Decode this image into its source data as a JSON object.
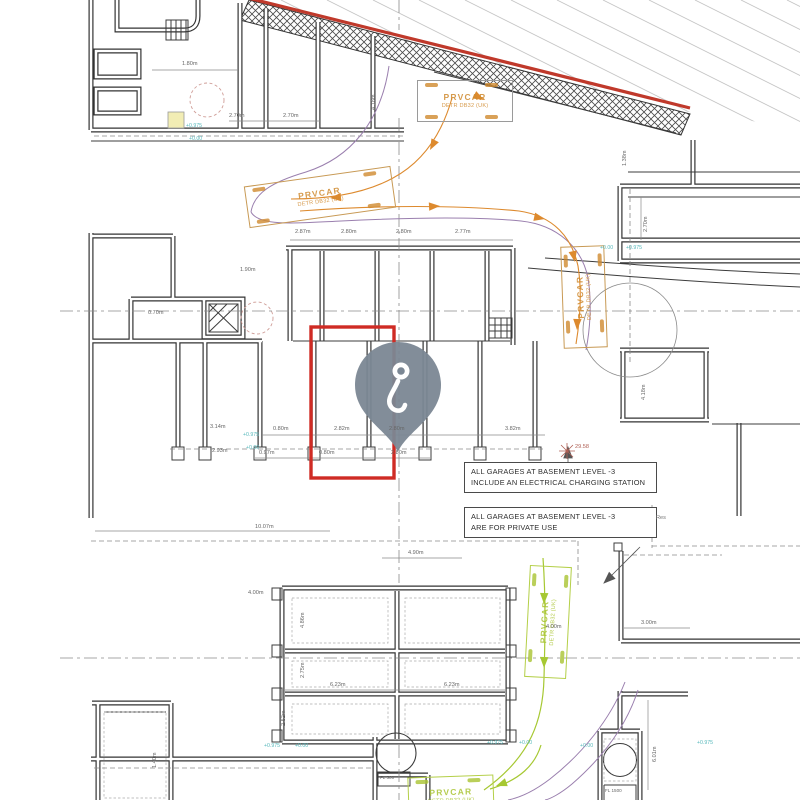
{
  "plan": {
    "notes": [
      {
        "line1": "ALL GARAGES AT BASEMENT LEVEL -3",
        "line2": "INCLUDE AN ELECTRICAL CHARGING STATION"
      },
      {
        "line1": "ALL GARAGES AT BASEMENT LEVEL -3",
        "line2": "ARE FOR PRIVATE USE"
      }
    ],
    "car_stamp": {
      "title": "PRVCAR",
      "subtitle": "DETR DB32 (UK)"
    },
    "levels": {
      "upper": "+0.975",
      "lower": "+0.00"
    },
    "survey_point": "29.58",
    "right_edge_label": "Res",
    "equipment": {
      "small": "FL 500",
      "large": "FL 1500"
    },
    "dims": {
      "t1": "2.70m",
      "t2": "2.70m",
      "t3": "1.80m",
      "t4": "4.18m",
      "m1": "2.87m",
      "m2": "2.80m",
      "m3": "2.80m",
      "m4": "2.77m",
      "m5": "1.90m",
      "m6": "0.70m",
      "b1": "0.80m",
      "b2": "2.82m",
      "b3": "2.80m",
      "b4": "3.82m",
      "b5": "0.97m",
      "b6": "0.80m",
      "b7": "2.80m",
      "b8": "3.14m",
      "b9": "2.93m",
      "r1": "2.70m",
      "r2": "4.18m",
      "r3": "3.00m",
      "r4": "6.01m",
      "r5": "1.38m",
      "lo1": "10.07m",
      "lo2": "4.00m",
      "lo3": "6.23m",
      "lo4": "6.23m",
      "lo5": "4.86m",
      "lo6": "2.75m",
      "lo7": "2.52m",
      "lo8": "4.00m",
      "lo9": "1.40m",
      "lo10": "4.90m"
    }
  },
  "colors": {
    "selection": "#cf2b24",
    "pin": "#7b8794",
    "roof_line": "#c0392b",
    "orange_route": "#dd8a2e",
    "purple_route": "#9a7fae",
    "green_route": "#a6c832",
    "level_text": "#56b8bb"
  }
}
